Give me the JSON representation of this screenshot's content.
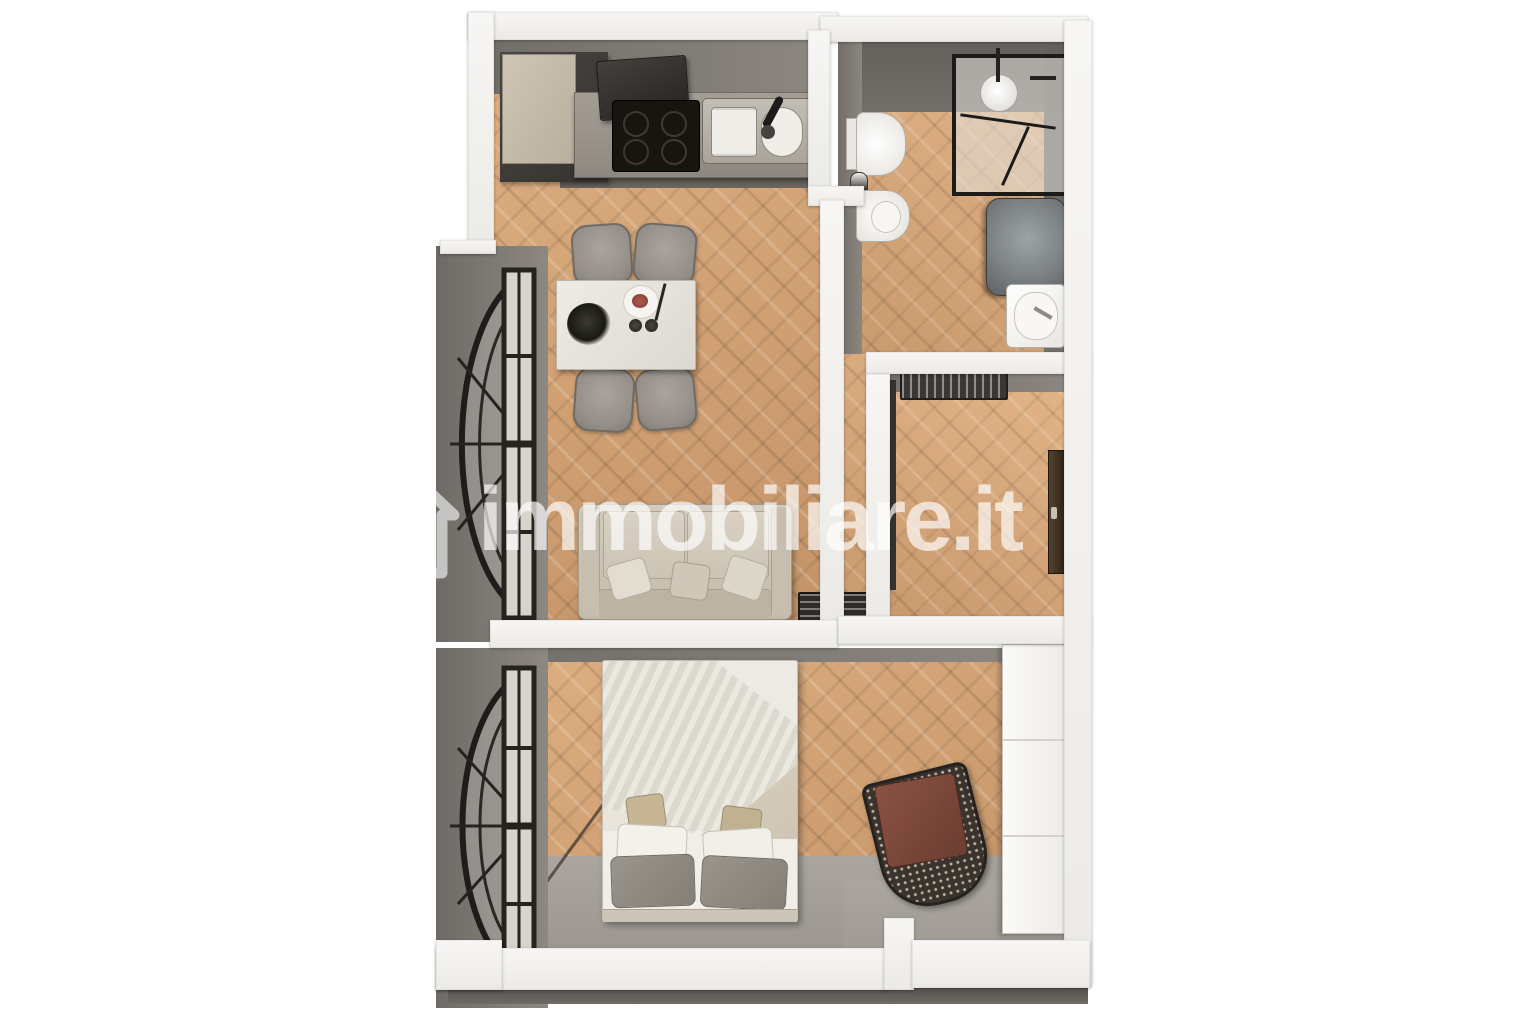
{
  "watermark": {
    "text": "immobiliare.it",
    "icon": "house-logo-icon",
    "color": "#ffffff"
  },
  "palette": {
    "background": "#ffffff",
    "cut_wall_white": "#f3f2ef",
    "interior_wall_gray": "#8a857f",
    "bathroom_wall_dark_gray": "#6b6763",
    "wood_floor": "#d2a376",
    "concrete_floor": "#9b968f",
    "kitchen_cabinet_dark": "#45413e",
    "counter_gray": "#9c968e",
    "sofa_beige": "#cdc5b7",
    "bed_duvet_taupe": "#a89f93",
    "armchair_cushion_brown": "#7c4a3b",
    "window_frame_black": "#1f1d1b"
  },
  "floor_plan": {
    "type": "3d-top-down-apartment-render",
    "rooms": [
      {
        "name": "living-room-with-kitchen",
        "floor": "herringbone wood",
        "items": [
          "tall cabinet",
          "range hood",
          "cooktop",
          "kitchen sink",
          "kitchen counter",
          "dining table",
          "dining chairs x4",
          "table plant",
          "plate with food",
          "sofa with pillows",
          "floor grille"
        ]
      },
      {
        "name": "bathroom",
        "floor": "herringbone wood",
        "items": [
          "wall-hung toilet",
          "toilet brush",
          "bidet",
          "glass shower enclosure",
          "shower head",
          "water heater cylinder",
          "washbasin"
        ]
      },
      {
        "name": "entry-hall",
        "floor": "herringbone wood",
        "items": [
          "radiator",
          "entrance door"
        ]
      },
      {
        "name": "bedroom",
        "floor": "herringbone wood with gray screed strip",
        "items": [
          "double bed",
          "gray duvet",
          "pillows x6",
          "rattan armchair with brown cushion",
          "white wardrobe"
        ]
      }
    ],
    "windows": [
      "arched black-frame window in living room (left wall)",
      "arched black-frame window in bedroom (left wall)"
    ]
  }
}
